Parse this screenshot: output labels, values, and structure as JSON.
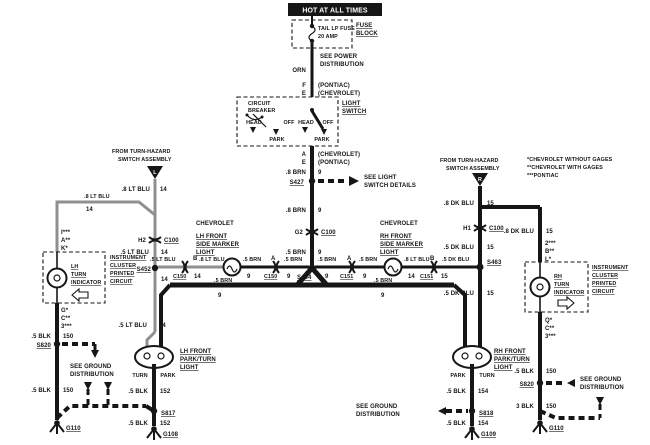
{
  "colors": {
    "ink": "#161616",
    "halftone": "#8f8f8f",
    "paper": "#ffffff"
  },
  "banner": {
    "label": "HOT AT ALL TIMES"
  },
  "fuse_block": {
    "fuse1": "TAIL LP FUSE",
    "fuse2": "20 AMP",
    "name1": "FUSE",
    "name2": "BLOCK"
  },
  "power": {
    "see1": "SEE POWER",
    "see2": "DISTRIBUTION",
    "wire": "ORN",
    "pin_f": "F",
    "pin_f_make": "(PONTIAC)",
    "pin_e": "E",
    "pin_e_make": "(CHEVROLET)"
  },
  "lswitch": {
    "cb1": "CIRCUIT",
    "cb2": "BREAKER",
    "head1": "HEAD",
    "off1": "OFF",
    "head2": "HEAD",
    "off2": "OFF",
    "park1": "PARK",
    "park2": "PARK",
    "name1": "LIGHT",
    "name2": "SWITCH",
    "pin_a": "A",
    "pin_a_make": "(CHEVROLET)",
    "pin_e": "E",
    "pin_e_make": "(PONTIAC)"
  },
  "center": {
    "wire1": ".8 BRN",
    "ckt1": "9",
    "splice1": "S427",
    "see1": "SEE LIGHT",
    "see2": "SWITCH DETAILS",
    "wire2": ".8 BRN",
    "ckt2": "9",
    "pin": "G2",
    "conn": "C100",
    "wire3": ".5 BRN",
    "ckt3": "9",
    "splice2": "S464"
  },
  "legend": {
    "l1": "*CHEVROLET WITHOUT GAGES",
    "l2": "**CHEVROLET WITH GAGES",
    "l3": "***PONTIAC"
  },
  "lfeed": {
    "from1": "FROM TURN-HAZARD",
    "from2": "SWITCH ASSEMBLY",
    "tri": "L",
    "wire1": ".8 LT BLU",
    "ckt1": "14",
    "wire2": ".8 LT BLU",
    "ckt2": "14",
    "pin": "H2",
    "conn": "C100",
    "wire3": ".5 LT BLU",
    "ckt3": "14",
    "splice": "S452",
    "ckt4": "14",
    "wire4": ".5 LT BLU",
    "ckt5": "14"
  },
  "lcluster": {
    "pin1": "I***",
    "pin2": "A**",
    "pin3": "K*",
    "ind1": "LH",
    "ind2": "TURN",
    "ind3": "INDICATOR",
    "t1": "INSTRUMENT",
    "t2": "CLUSTER",
    "t3": "PRINTED",
    "t4": "CIRCUIT",
    "pin4": "G*",
    "pin5": "C**",
    "pin6": "3***",
    "wire1": ".5 BLK",
    "ckt1": "150",
    "splice": "S820",
    "see1": "SEE GROUND",
    "see2": "DISTRIBUTION",
    "wire2": ".5 BLK",
    "ckt2": "150",
    "gnd": "G110"
  },
  "lmarker": {
    "make": "CHEVROLET",
    "n1": "LH FRONT",
    "n2": "SIDE MARKER",
    "n3": "LIGHT",
    "wire_b": ".5 LT BLU",
    "pin_b": "B",
    "wire_b2": ".8 LT BLU",
    "conn_b": "C150",
    "ckt_b": "14",
    "wire_a1": ".5 BRN",
    "ckt_a1": "9",
    "pin_a": "A",
    "conn_a": "C150",
    "ckt_a2": "9",
    "wire_a2": ".5 BRN"
  },
  "rmarker": {
    "make": "CHEVROLET",
    "n1": "RH FRONT",
    "n2": "SIDE MARKER",
    "n3": "LIGHT",
    "wire_a1": ".5 BRN",
    "ckt_a1": "9",
    "pin_a": "A",
    "conn_a": "C151",
    "ckt_a2": "9",
    "wire_a2": ".5 BRN",
    "wire_b": ".8 LT BLU",
    "pin_b": "B",
    "ckt_b": "14",
    "conn_b": "C151",
    "ckt_b2": "15",
    "wire_c": ".5 DK BLU"
  },
  "parkfeed": {
    "wire_l": ".5 BRN",
    "ckt_l": "9",
    "wire_r": ".5 BRN",
    "ckt_r": "9"
  },
  "rfeed": {
    "from1": "FROM TURN-HAZARD",
    "from2": "SWITCH ASSEMBLY",
    "tri": "R",
    "wire1": ".8 DK BLU",
    "ckt1": "15",
    "wire2": ".8 DK BLU",
    "ckt2": "15",
    "pin": "H1",
    "conn": "C100",
    "wire3": ".5 DK BLU",
    "ckt3": "15",
    "splice": "S463",
    "wire4": ".5 DK BLU",
    "ckt4": "15"
  },
  "rcluster": {
    "pin1": "2***",
    "pin2": "B**",
    "pin3": "L*",
    "ind1": "RH",
    "ind2": "TURN",
    "ind3": "INDICATOR",
    "t1": "INSTRUMENT",
    "t2": "CLUSTER",
    "t3": "PRINTED",
    "t4": "CIRCUIT",
    "pin4": "Q*",
    "pin5": "C**",
    "pin6": "3***",
    "wire1": ".5 BLK",
    "ckt1": "150",
    "splice": "S820",
    "see1": "SEE GROUND",
    "see2": "DISTRIBUTION",
    "wire2": "3 BLK",
    "ckt2": "150",
    "gnd": "G110"
  },
  "llight": {
    "n1": "LH FRONT",
    "n2": "PARK/TURN",
    "n3": "LIGHT",
    "turn": "TURN",
    "park": "PARK",
    "wire1": ".5 BLK",
    "ckt1": "152",
    "splice": "S817",
    "wire2": ".5 BLK",
    "ckt2": "152",
    "gnd": "G108"
  },
  "rlight": {
    "n1": "RH FRONT",
    "n2": "PARK/TURN",
    "n3": "LIGHT",
    "park": "PARK",
    "turn": "TURN",
    "wire1": ".5 BLK",
    "ckt1": "154",
    "splice": "S818",
    "wire2": ".5 BLK",
    "ckt2": "154",
    "gnd": "G109"
  },
  "cground": {
    "see1": "SEE GROUND",
    "see2": "DISTRIBUTION"
  }
}
